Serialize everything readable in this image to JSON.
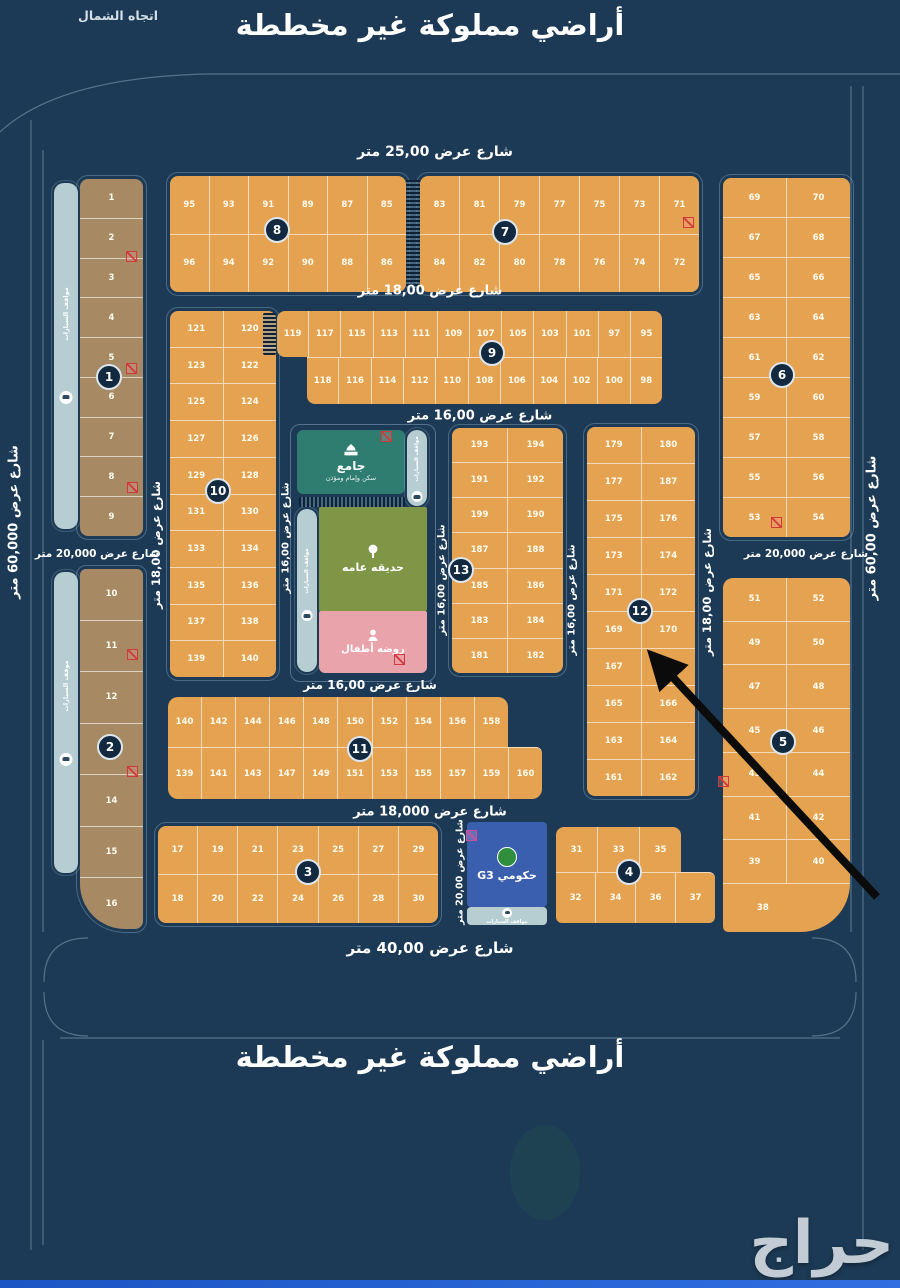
{
  "meta": {
    "title_top": "أراضي مملوكة غير مخططة",
    "title_bottom": "أراضي مملوكة غير مخططة",
    "north_label": "اتجاه الشمال",
    "watermark": "حراج"
  },
  "colors": {
    "bg": "#1c3a55",
    "plot": "#e5a351",
    "tan": "#a78a64",
    "parking": "#b6cdd2",
    "mosque": "#2f7d70",
    "park": "#7f9646",
    "kg": "#e9a3ab",
    "gov": "#3a5fae",
    "red": "#d03a3a",
    "pink": "#cc4f9e",
    "arrow": "#0b0b0b"
  },
  "streets": {
    "width25": "شارع عرض 25,00 متر",
    "width18_top": "شارع عرض 18,00 متر",
    "width16_mid": "شارع عرض 16,00 متر",
    "width16_fac": "شارع عرض 16,00 متر",
    "width18k": "شارع عرض 18,000 متر",
    "width40": "شارع عرض 40,00 متر",
    "width20k_left": "شارع عرض 20,000 متر",
    "width20k_right": "شارع عرض 20,000 متر",
    "width60_left": "شارع عرض 60,000 متر",
    "width60_right": "شارع عرض 60,00 متر",
    "v18_left": "شارع عرض 18,00 متر",
    "v18_right": "شارع عرض 18,00 متر",
    "v16_a": "شارع عرض 16,00 متر",
    "v16_b": "شارع عرض 16,00 متر",
    "v16_c": "شارع عرض 16,00 متر",
    "v20": "شارع عرض 20,00 متر"
  },
  "facilities": {
    "mosque": {
      "title": "جامع",
      "subtitle": "سكن وإمام ومؤذن"
    },
    "park": {
      "title": "حديقه عامه"
    },
    "kindergarten": {
      "title": "روضه أطفال"
    },
    "government": {
      "title": "حكومي G3"
    },
    "parking_label": "مواقف السيارات"
  },
  "blocks": {
    "b1": {
      "badge": "1",
      "parking_label": "مواقف السيارات",
      "rows": [
        [
          "1"
        ],
        [
          "2"
        ],
        [
          "3"
        ],
        [
          "4"
        ],
        [
          "5"
        ],
        [
          "6"
        ],
        [
          "7"
        ],
        [
          "8"
        ],
        [
          "9"
        ]
      ]
    },
    "b2": {
      "badge": "2",
      "parking_label": "موقف السيارات",
      "rows": [
        [
          "10"
        ],
        [
          "11"
        ],
        [
          "12"
        ],
        [
          "13"
        ],
        [
          "14"
        ],
        [
          "15"
        ],
        [
          "16"
        ]
      ]
    },
    "b3": {
      "badge": "3",
      "rows": [
        [
          "17",
          "19",
          "21",
          "23",
          "25",
          "27",
          "29"
        ],
        [
          "18",
          "20",
          "22",
          "24",
          "26",
          "28",
          "30"
        ]
      ]
    },
    "b4": {
      "badge": "4",
      "rows_top": [
        [
          "31",
          "33",
          "35"
        ]
      ],
      "rows_bottom": [
        [
          "32",
          "34",
          "36",
          "37"
        ]
      ]
    },
    "b5": {
      "badge": "5",
      "plot_38": "38",
      "rows": [
        [
          "51",
          "52"
        ],
        [
          "49",
          "50"
        ],
        [
          "47",
          "48"
        ],
        [
          "45",
          "46"
        ],
        [
          "43",
          "44"
        ],
        [
          "41",
          "42"
        ],
        [
          "39",
          "40"
        ]
      ]
    },
    "b6": {
      "badge": "6",
      "rows": [
        [
          "69",
          "70"
        ],
        [
          "67",
          "68"
        ],
        [
          "65",
          "66"
        ],
        [
          "63",
          "64"
        ],
        [
          "61",
          "62"
        ],
        [
          "59",
          "60"
        ],
        [
          "57",
          "58"
        ],
        [
          "55",
          "56"
        ],
        [
          "53",
          "54"
        ]
      ]
    },
    "b7": {
      "badge": "7",
      "rows": [
        [
          "83",
          "81",
          "79",
          "77",
          "75",
          "73",
          "71"
        ],
        [
          "84",
          "82",
          "80",
          "78",
          "76",
          "74",
          "72"
        ]
      ]
    },
    "b8": {
      "badge": "8",
      "rows": [
        [
          "95",
          "93",
          "91",
          "89",
          "87",
          "85"
        ],
        [
          "96",
          "94",
          "92",
          "90",
          "88",
          "86"
        ]
      ]
    },
    "b9": {
      "badge": "9",
      "rows_top": [
        [
          "119",
          "117",
          "115",
          "113",
          "111",
          "109",
          "107",
          "105",
          "103",
          "101",
          "97",
          "95"
        ]
      ],
      "rows_bottom": [
        [
          "118",
          "116",
          "114",
          "112",
          "110",
          "108",
          "106",
          "104",
          "102",
          "100",
          "98"
        ]
      ]
    },
    "b10": {
      "badge": "10",
      "rows": [
        [
          "121",
          "120"
        ],
        [
          "123",
          "122"
        ],
        [
          "125",
          "124"
        ],
        [
          "127",
          "126"
        ],
        [
          "129",
          "128"
        ],
        [
          "131",
          "130"
        ],
        [
          "133",
          "134"
        ],
        [
          "135",
          "136"
        ],
        [
          "137",
          "138"
        ],
        [
          "139",
          "140"
        ]
      ]
    },
    "b11": {
      "badge": "11",
      "rows_top": [
        [
          "140",
          "142",
          "144",
          "146",
          "148",
          "150",
          "152",
          "154",
          "156",
          "158"
        ]
      ],
      "rows_bottom": [
        [
          "139",
          "141",
          "143",
          "147",
          "149",
          "151",
          "153",
          "155",
          "157",
          "159",
          "160"
        ]
      ]
    },
    "b12": {
      "badge": "12",
      "rows": [
        [
          "179",
          "180"
        ],
        [
          "177",
          "187"
        ],
        [
          "175",
          "176"
        ],
        [
          "173",
          "174"
        ],
        [
          "171",
          "172"
        ],
        [
          "169",
          "170"
        ],
        [
          "167",
          "168"
        ],
        [
          "165",
          "166"
        ],
        [
          "163",
          "164"
        ],
        [
          "161",
          "162"
        ]
      ]
    },
    "b13": {
      "badge": "13",
      "rows": [
        [
          "193",
          "194"
        ],
        [
          "191",
          "192"
        ],
        [
          "199",
          "190"
        ],
        [
          "187",
          "188"
        ],
        [
          "185",
          "186"
        ],
        [
          "183",
          "184"
        ],
        [
          "181",
          "182"
        ]
      ]
    }
  }
}
